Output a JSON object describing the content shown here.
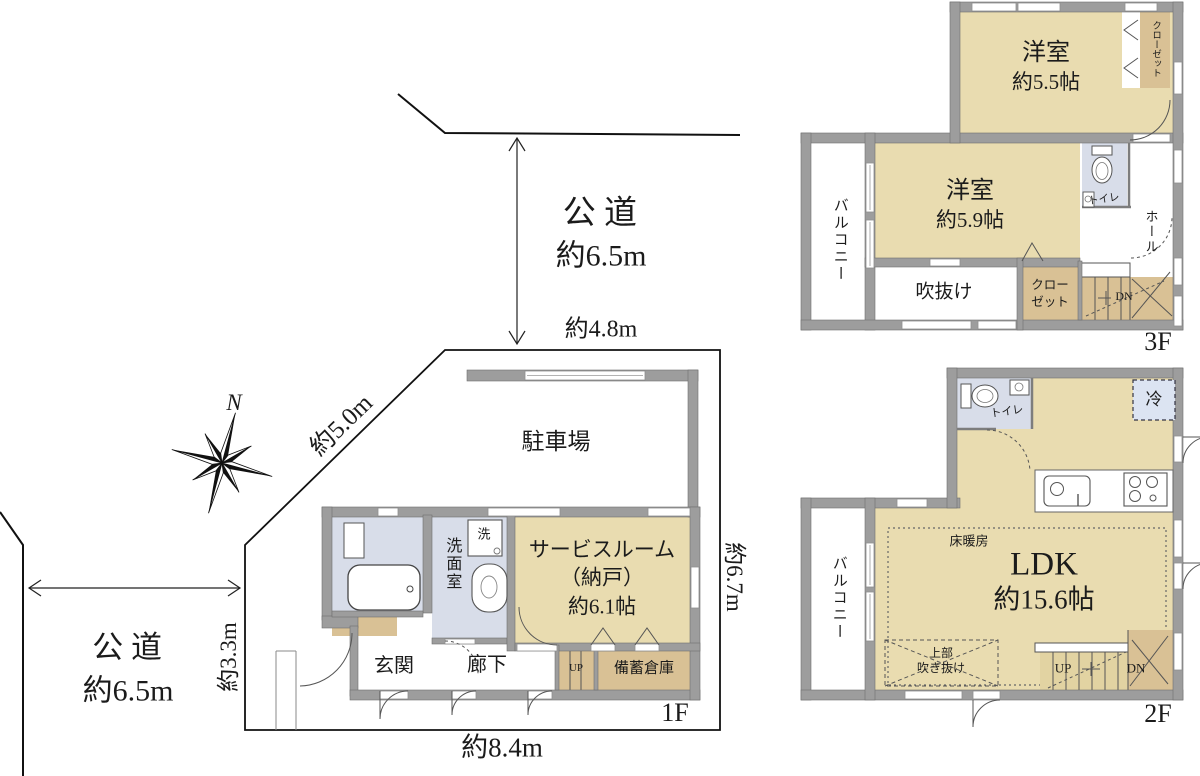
{
  "site": {
    "north": "N",
    "roads": {
      "top": {
        "label": "公道",
        "width": "約6.5m"
      },
      "left": {
        "label": "公道",
        "width": "約6.5m"
      }
    },
    "dimensions": {
      "top": "約4.8m",
      "diagonal": "約5.0m",
      "right": "約6.7m",
      "left": "約3.3m",
      "bottom": "約8.4m"
    }
  },
  "floor1": {
    "label": "1F",
    "rooms": {
      "parking": "駐車場",
      "service_room_line1": "サービスルーム",
      "service_room_line2": "（納戸）",
      "service_room_line3": "約6.1帖",
      "washroom": "洗面室",
      "washer": "洗",
      "entrance": "玄関",
      "corridor": "廊下",
      "stairs_up": "UP",
      "storage": "備蓄倉庫"
    }
  },
  "floor2": {
    "label": "2F",
    "rooms": {
      "ldk_line1": "LDK",
      "ldk_line2": "約15.6帖",
      "balcony": "バルコニー",
      "toilet": "トイレ",
      "fridge": "冷",
      "floor_heating": "床暖房",
      "void_line1": "上部",
      "void_line2": "吹き抜け",
      "stairs_up": "UP",
      "stairs_dn": "DN"
    }
  },
  "floor3": {
    "label": "3F",
    "rooms": {
      "bedroom1_line1": "洋室",
      "bedroom1_line2": "約5.5帖",
      "bedroom2_line1": "洋室",
      "bedroom2_line2": "約5.9帖",
      "balcony": "バルコニー",
      "void": "吹抜け",
      "closet_upper": "クローゼット",
      "closet_lower_line1": "クロー",
      "closet_lower_line2": "ゼット",
      "toilet": "トイレ",
      "hall": "ホール",
      "stairs_dn": "DN"
    }
  },
  "colors": {
    "room_tan": "#e9dcb0",
    "closet_tan": "#d9c195",
    "wet_blue": "#d8dde9",
    "fridge_blue": "#dce4f2",
    "wall_gray": "#9d9d9d",
    "line": "#222222"
  }
}
